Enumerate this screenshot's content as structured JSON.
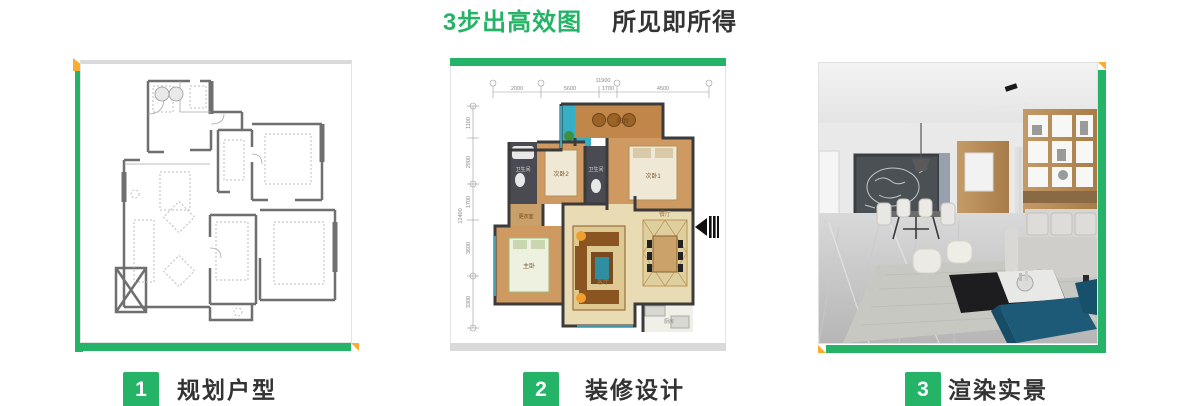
{
  "title": {
    "highlight": "3步出高效图",
    "rest": "所见即所得"
  },
  "steps": [
    {
      "number": "1",
      "label": "规划户型"
    },
    {
      "number": "2",
      "label": "装修设计"
    },
    {
      "number": "3",
      "label": "渲染实景"
    }
  ],
  "floorplan": {
    "total_width": "11900",
    "dims_top": [
      "2000",
      "5600",
      "1700",
      "4500"
    ],
    "total_height": "12400",
    "dims_left": [
      "1100",
      "2900",
      "1700",
      "3600",
      "3300"
    ],
    "rooms": {
      "balcony": "阳台",
      "bedroom1": "次卧1",
      "bedroom2": "次卧2",
      "bath1": "卫生间",
      "bath2": "卫生间",
      "closet": "更衣室",
      "master": "主卧",
      "living": "客厅",
      "dining": "餐厅",
      "kitchen": "厨房"
    }
  },
  "colors": {
    "green": "#25b467",
    "yellow": "#fbab2e",
    "dark_text": "#333333",
    "gray_strip": "#d9d9d9"
  }
}
